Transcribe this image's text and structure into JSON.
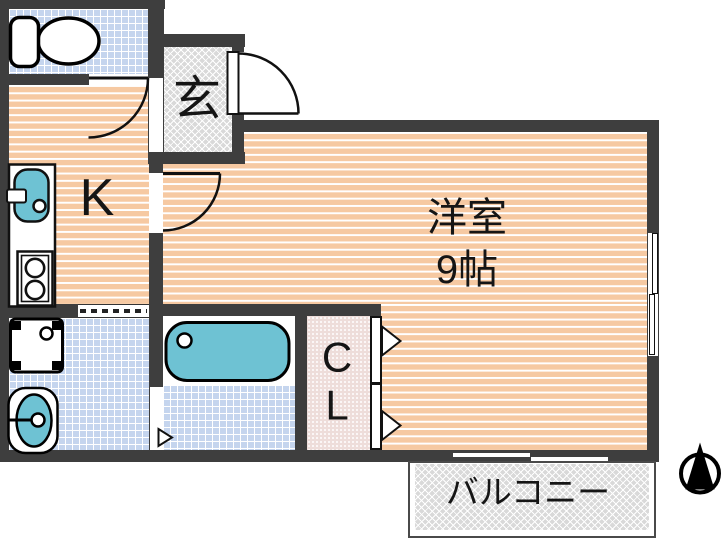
{
  "plan": {
    "labels": {
      "entrance": "玄",
      "kitchen": "K",
      "main_room_name": "洋室",
      "main_room_size": "9帖",
      "closet_line1": "C",
      "closet_line2": "L",
      "balcony": "バルコニー"
    },
    "colors": {
      "wall": "#3e3e3e",
      "floor_wood": "#f6c9a2",
      "tile_blue": "#c5d5ee",
      "fixture_teal": "#6ec2d3",
      "entrance_gray": "#d9d9d9",
      "closet_pink": "#eeddda",
      "line_black": "#111111"
    },
    "icons": {
      "toilet": "toilet-icon (tank + bowl shape)",
      "kitchen_sink": "kitchen-sink-icon (teal basin + faucet)",
      "stove": "stove-burners-icon (two circles)",
      "washing_machine": "washing-machine-pan-icon (square + drain circle)",
      "vanity": "vanity-sink-icon (oval basin + faucet)",
      "bathtub": "bathtub-icon (rounded teal tub + drain circle)",
      "compass": "north-arrow-icon (circle + solid triangle)"
    }
  }
}
